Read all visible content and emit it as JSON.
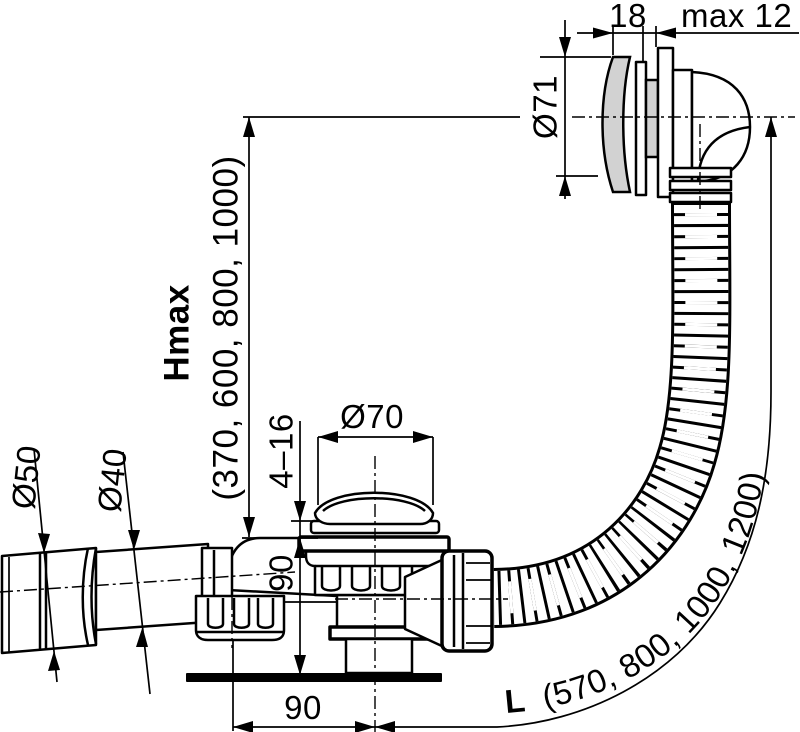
{
  "dims": {
    "cap_width": "18",
    "panel_max": "max 12",
    "overflow_cap_dia": "Ø71",
    "hmax_label": "Hmax",
    "hmax_values": "(370, 600, 800, 1000)",
    "plug_dia": "Ø70",
    "clamp_range": "4–16",
    "body_height": "90",
    "outlet_offset": "90",
    "inlet_dia_outer": "Ø50",
    "inlet_dia_inner": "Ø40",
    "hose_len_label": "L",
    "hose_len_values": "(570, 800, 1000, 1200)"
  },
  "colors": {
    "line": "#000000",
    "background": "#ffffff",
    "cap_fill": "#d2d2d2",
    "gasket_fill": "#c6c6c6"
  }
}
